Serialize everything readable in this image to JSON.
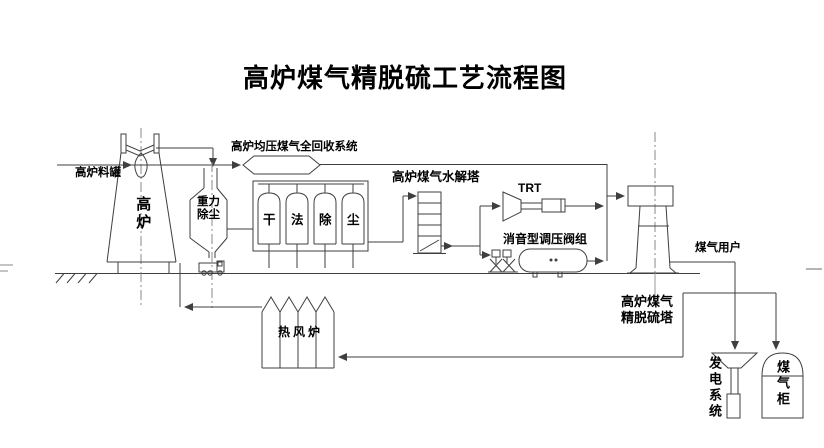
{
  "title": "高炉煤气精脱硫工艺流程图",
  "colors": {
    "background": "#ffffff",
    "line": "#3f3f3f",
    "centerline": "#8a8a8a",
    "text": "#000000"
  },
  "labels": {
    "charging_tank": "高炉料罐",
    "blast_furnace": "高炉",
    "gravity_dedusting_line1": "重力",
    "gravity_dedusting_line2": "除尘",
    "recovery_system": "高炉均压煤气全回收系统",
    "dry_dedusting_chars": [
      "干",
      "法",
      "除",
      "尘"
    ],
    "hydrolysis_tower": "高炉煤气水解塔",
    "trt": "TRT",
    "valve_group": "消音型调压阀组",
    "gas_users": "煤气用户",
    "desulfurization_tower_line1": "高炉煤气",
    "desulfurization_tower_line2": "精脱硫塔",
    "hot_blast_stove": "热风炉",
    "power_generation": "发电系统",
    "gas_holder": "煤气柜"
  }
}
